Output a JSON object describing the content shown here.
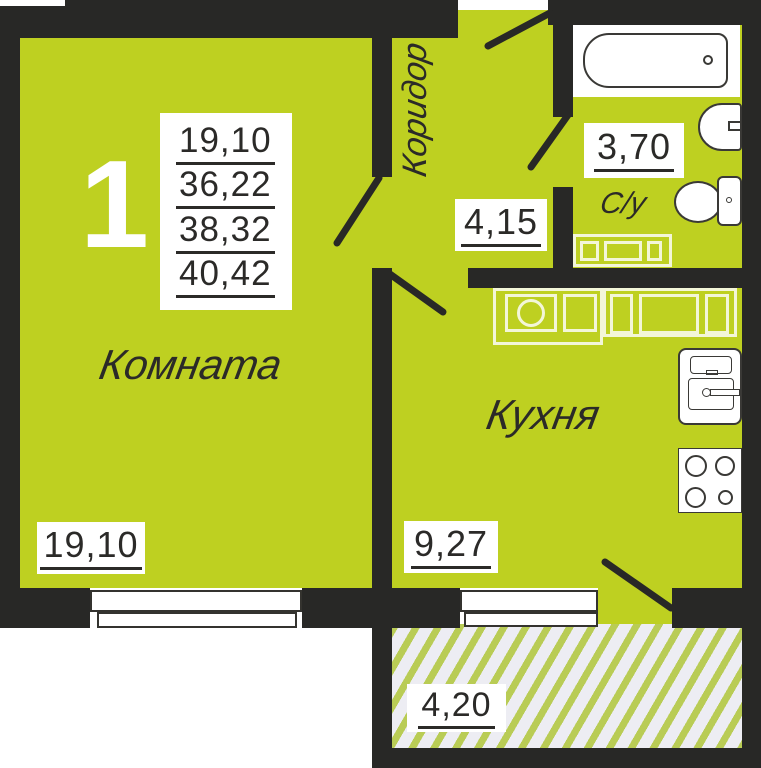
{
  "apartment": {
    "number": "1"
  },
  "summary_areas": [
    "19,10",
    "36,22",
    "38,32",
    "40,42"
  ],
  "rooms": {
    "living": {
      "label": "Комната",
      "area": "19,10"
    },
    "corridor": {
      "label": "Коридор",
      "area": "4,15"
    },
    "bathroom": {
      "label": "С/у",
      "area": "3,70"
    },
    "kitchen": {
      "label": "Кухня",
      "area": "9,27"
    },
    "balcony": {
      "area": "4,20"
    }
  },
  "colors": {
    "floor": "#bed021",
    "wall": "#282826",
    "hatch_bg": "#ededf3",
    "hatch_stripe": "#b9cc55",
    "ink": "#2b2a28"
  }
}
